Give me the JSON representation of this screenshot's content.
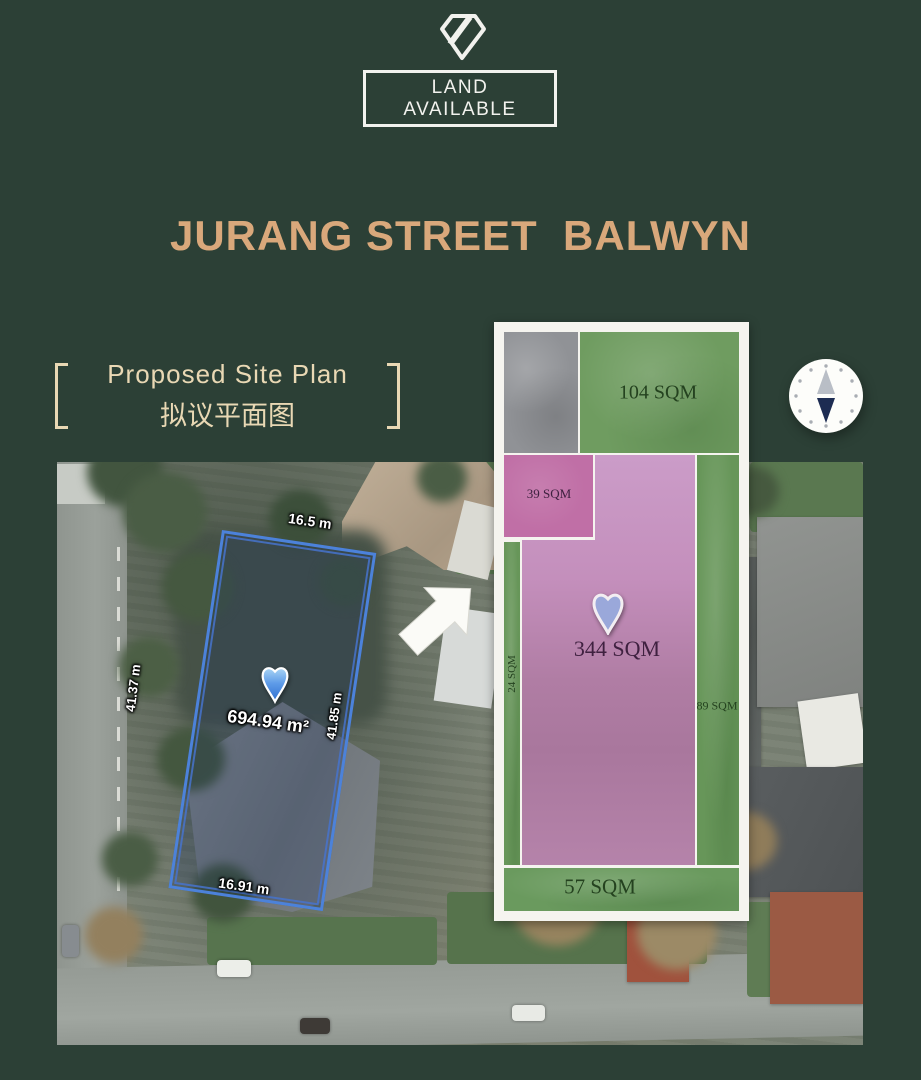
{
  "page": {
    "background_color": "#2C4036",
    "accent_color": "#D9A87B",
    "cream_color": "#E9D8B4"
  },
  "header": {
    "logo_icon": "diamond-gem",
    "badge_line1": "LAND",
    "badge_line2": "AVAILABLE"
  },
  "title": "JURANG STREET  BALWYN",
  "section_label": {
    "bracket_left": "[",
    "bracket_right": "]",
    "heading_en": "Proposed Site Plan",
    "heading_zh": "拟议平面图"
  },
  "compass": {
    "needle_up_color": "#B9BEC6",
    "needle_down_color": "#1D2C52"
  },
  "lot": {
    "outline_color": "#4C82DA",
    "area_label": "694.94 m²",
    "width_top": "16.5 m",
    "length_left": "41.37 m",
    "length_right": "41.85 m",
    "width_bottom": "16.91 m"
  },
  "site_plan": {
    "areas": {
      "lawn_top": {
        "label": "104 SQM",
        "color": "#6F9C60"
      },
      "court_39": {
        "label": "39 SQM",
        "color": "#C06FA6"
      },
      "main_344": {
        "label": "344 SQM",
        "color": "#C48FBC"
      },
      "strip_left": {
        "label": "24 SQM",
        "color": "#679659"
      },
      "strip_right": {
        "label": "89 SQM",
        "color": "#679659"
      },
      "lawn_bottom": {
        "label": "57 SQM",
        "color": "#6A9A5E"
      }
    }
  }
}
